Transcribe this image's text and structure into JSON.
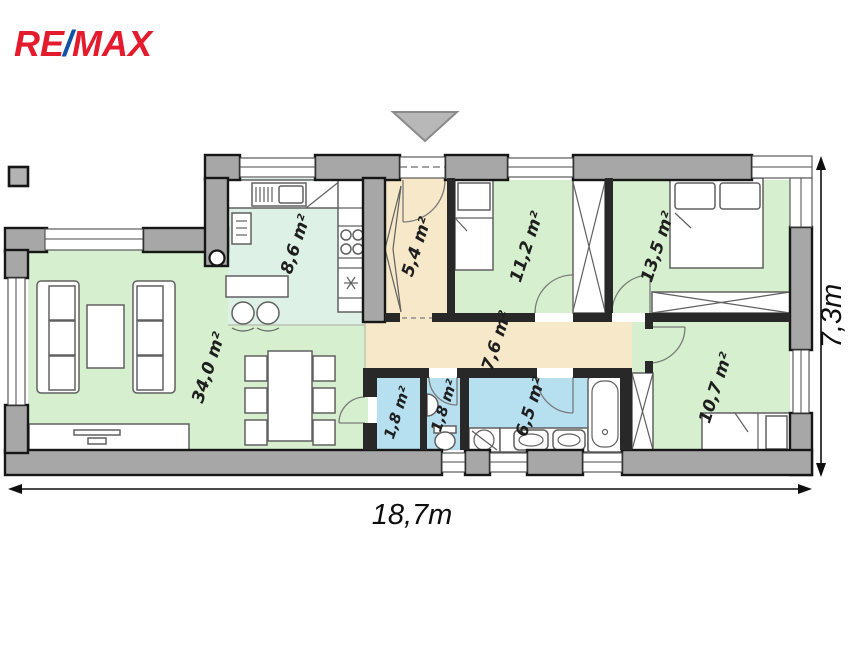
{
  "brand": {
    "name": "RE/MAX",
    "re": "RE",
    "slash": "/",
    "max": "MAX",
    "red": "#e31b2c",
    "blue": "#1053a5"
  },
  "plan": {
    "rooms": [
      {
        "id": "living-room",
        "label": "34,0 m²"
      },
      {
        "id": "kitchen",
        "label": "8,6 m²"
      },
      {
        "id": "entry-hall",
        "label": "5,4 m²"
      },
      {
        "id": "bedroom-1",
        "label": "11,2 m²"
      },
      {
        "id": "bedroom-2",
        "label": "13,5 m²"
      },
      {
        "id": "hallway",
        "label": "7,6 m²"
      },
      {
        "id": "storage",
        "label": "1,8 m²"
      },
      {
        "id": "wc",
        "label": "1,8 m²"
      },
      {
        "id": "bathroom",
        "label": "6,5 m²"
      },
      {
        "id": "bedroom-3",
        "label": "10,7 m²"
      }
    ],
    "dimensions": {
      "width": "18,7m",
      "height": "7,3m"
    },
    "colors": {
      "room_green": "#d6efcf",
      "kitchen_mint": "#ddf1e6",
      "hall_tan": "#f6e8c8",
      "wet_blue": "#b6dff0",
      "wall_gray": "#a7a7a7"
    }
  }
}
